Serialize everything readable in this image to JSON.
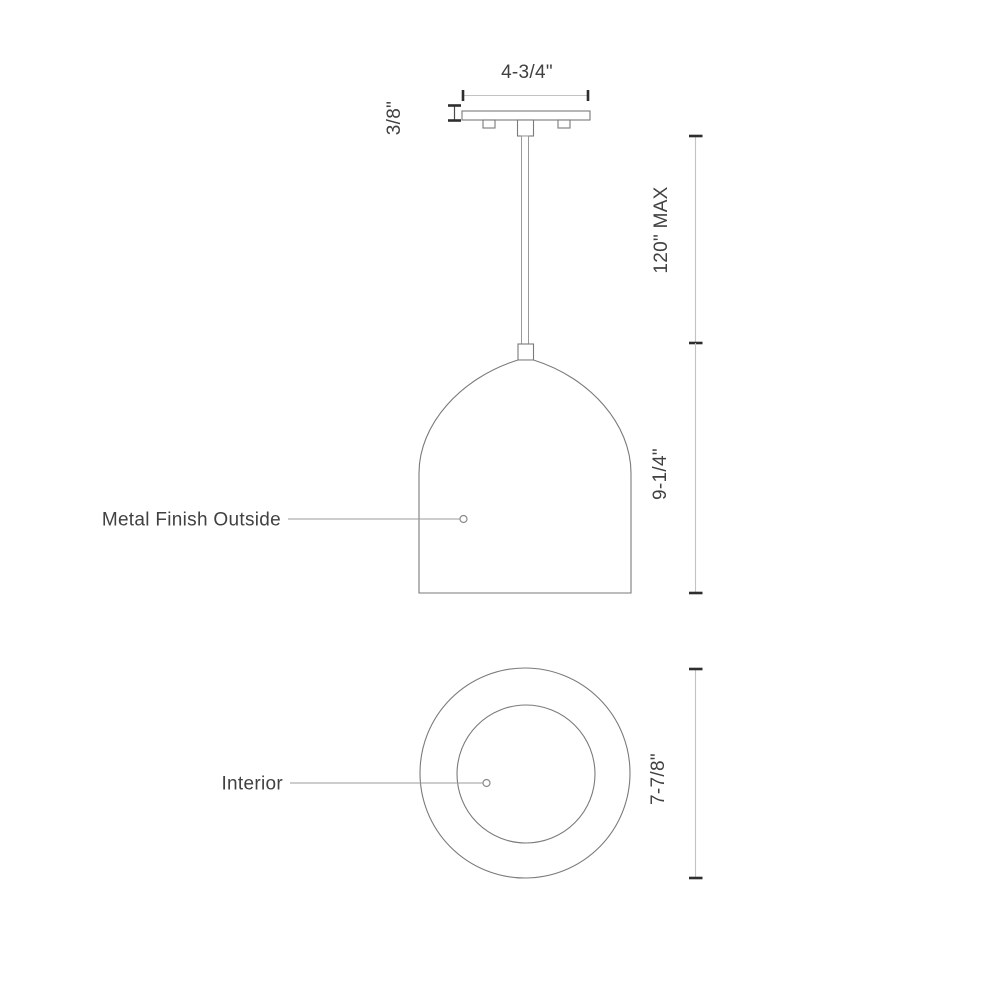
{
  "drawing": {
    "type": "technical-dimension-drawing",
    "subject": "pendant light fixture (front view and top view)",
    "colors": {
      "background": "#ffffff",
      "outline": "#7a7a7a",
      "dimension_line": "#c3c3c3",
      "tick": "#2e2e2e",
      "leader_line": "#9b9b9b",
      "text": "#414141"
    },
    "front_view": {
      "canopy_width_label": "4-3/4\"",
      "canopy_thickness_label": "3/8\"",
      "suspension_max_label": "120\" MAX",
      "shade_height_label": "9-1/4\"",
      "finish_callout": "Metal Finish Outside"
    },
    "top_view": {
      "interior_callout": "Interior",
      "interior_diameter_label": "7-7/8\""
    }
  }
}
